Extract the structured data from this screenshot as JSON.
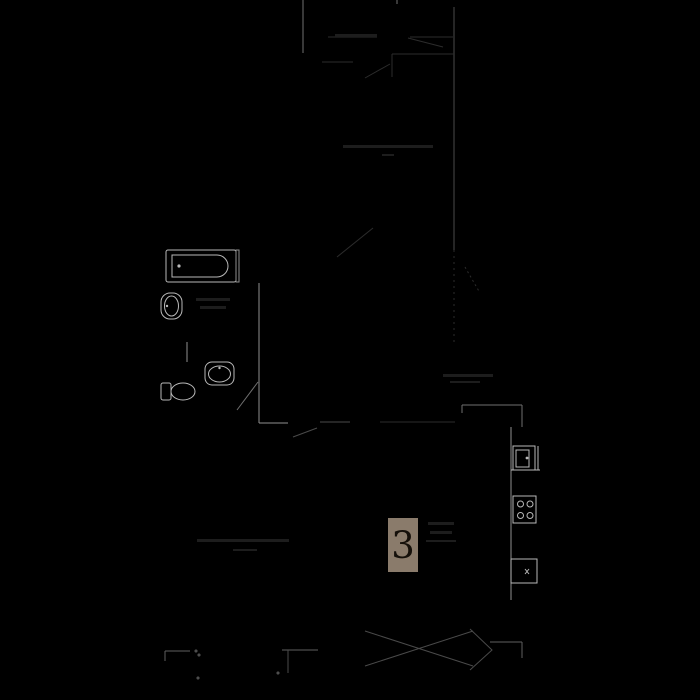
{
  "floor_plan": {
    "background_color": "#000000",
    "unit_badge": {
      "number": "3",
      "bg_color": "#8a7b6b",
      "text_color": "#15100a"
    },
    "line_colors": {
      "fixture": "#b9b9b9",
      "wall": "#8f8f8f",
      "wall_main": "#6f6f6f",
      "faint": "#2c2c2c",
      "furniture": "#5f5f5f",
      "label_marks": "#1d1d1d"
    },
    "icons": {
      "bathtub": "bathtub-icon",
      "small_basin": "small-washbasin-icon",
      "washbasin": "washbasin-icon",
      "toilet": "toilet-icon",
      "kitchen_sink": "kitchen-sink-icon",
      "cooktop": "cooktop-4-burner-icon",
      "appliance": "appliance-box-icon",
      "entrance_arrow": "entrance-arrow-icon"
    }
  }
}
